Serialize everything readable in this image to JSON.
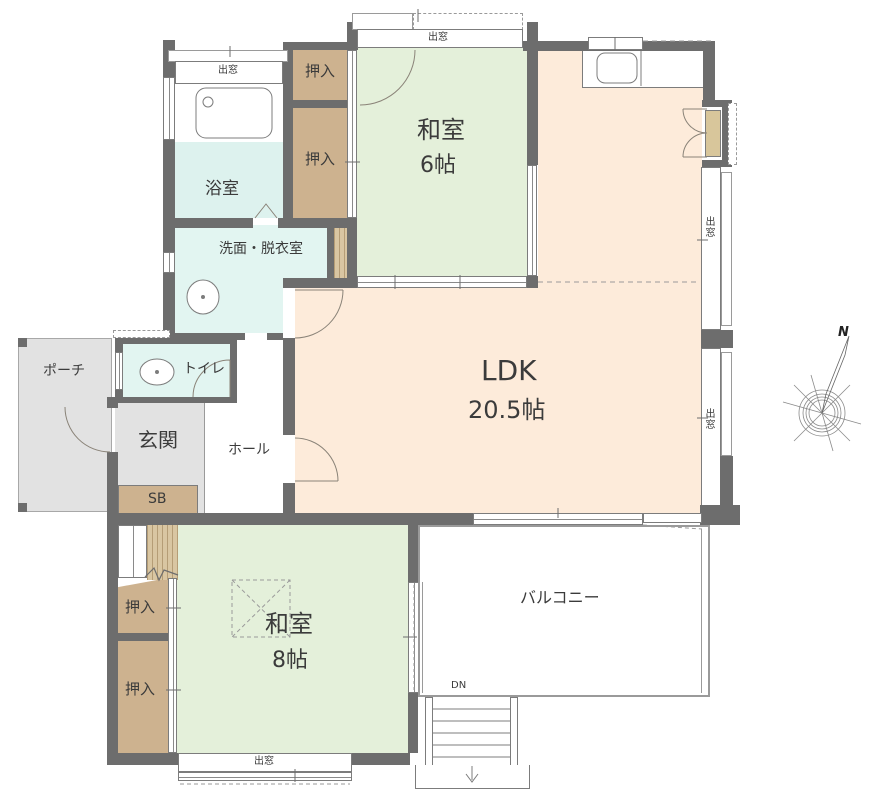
{
  "plan_title": "1F floor plan (Japanese house)",
  "colors": {
    "wall": "#6d6d6d",
    "tatami_green": "#e4f0da",
    "ldk_peach": "#fdebda",
    "closet_brown": "#cdb28f",
    "water_cyan": "#e2f5f1",
    "porch_gray": "#e2e2e2",
    "line_gray": "#7c7c7c"
  },
  "rooms": {
    "bath": {
      "label": "浴室"
    },
    "washroom": {
      "label": "洗面・脱衣室"
    },
    "toilet": {
      "label": "トイレ"
    },
    "porch": {
      "label": "ポーチ"
    },
    "entrance": {
      "label": "玄関"
    },
    "hall": {
      "label": "ホール"
    },
    "shoebox": {
      "label": "SB"
    },
    "closet": {
      "label": "押入"
    },
    "washitsu6": {
      "name": "和室",
      "size": "6帖"
    },
    "ldk": {
      "name": "LDK",
      "size": "20.5帖"
    },
    "washitsu8": {
      "name": "和室",
      "size": "8帖"
    },
    "balcony": {
      "label": "バルコニー"
    }
  },
  "annotations": {
    "bay_window": "出窓",
    "stairs_down": "DN",
    "north": "N"
  }
}
